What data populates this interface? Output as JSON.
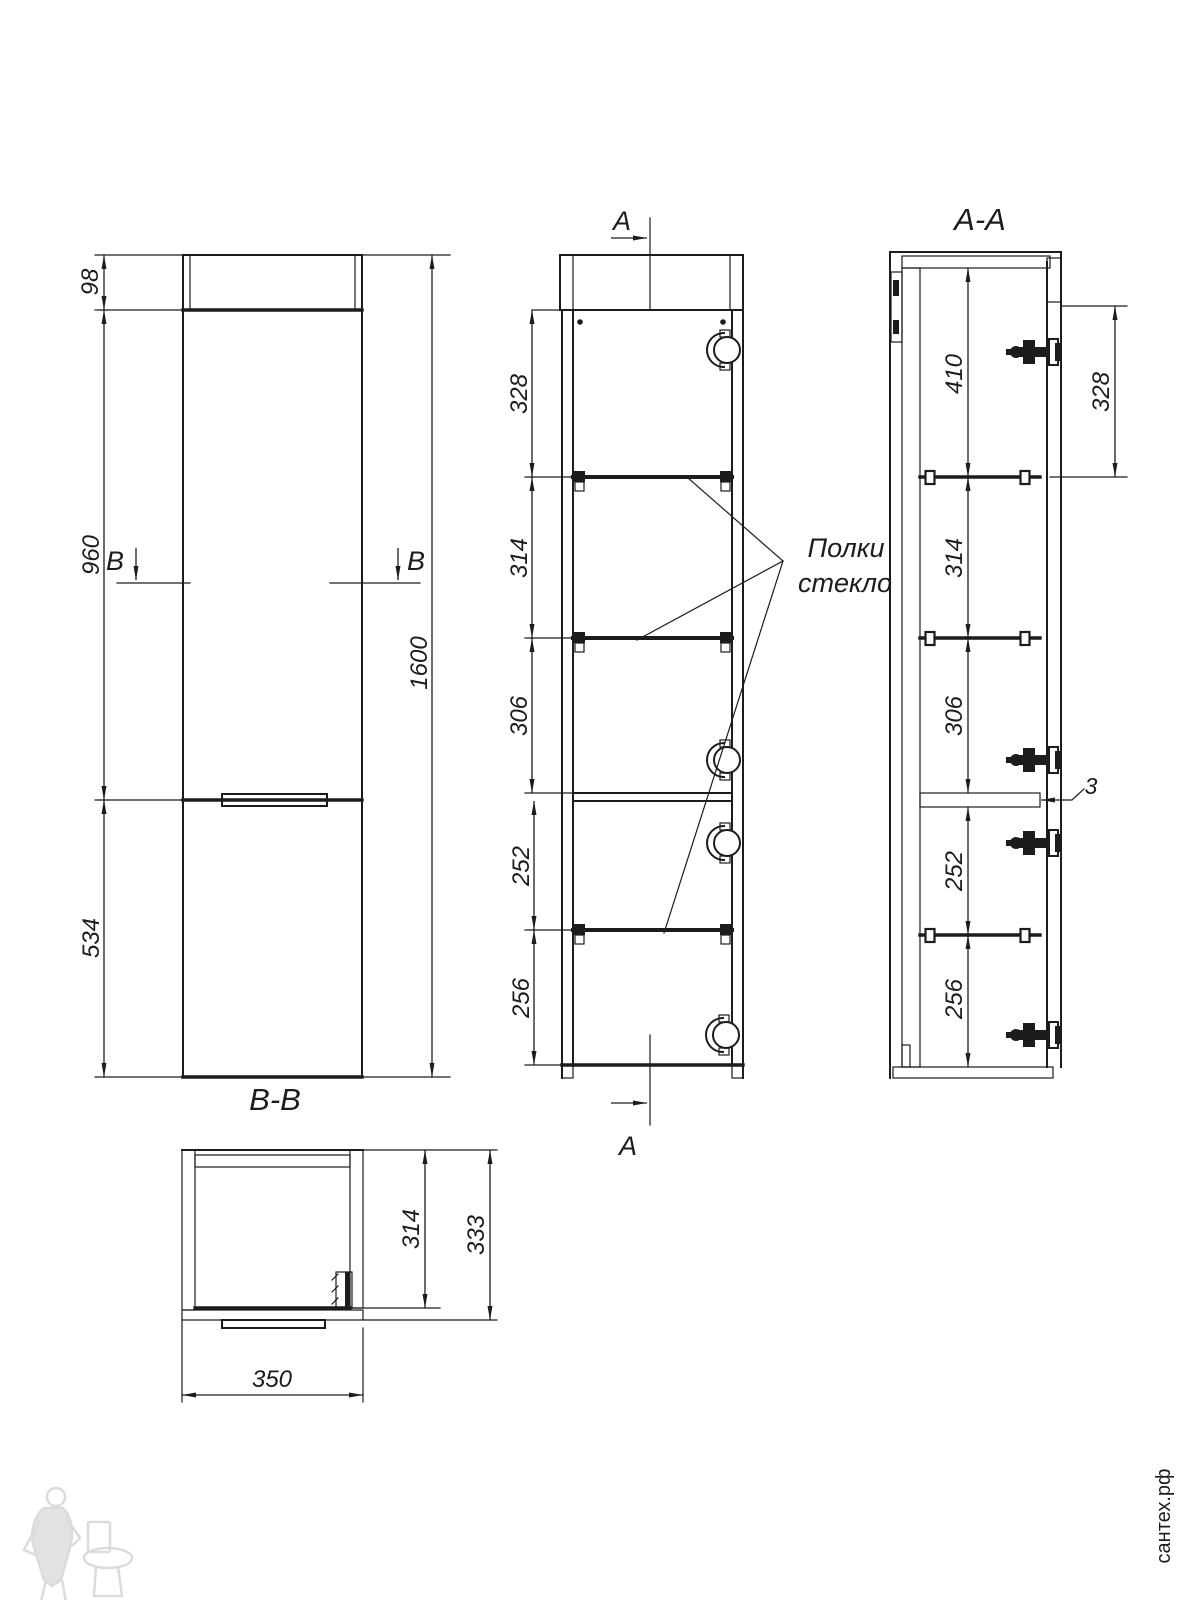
{
  "colors": {
    "line": "#1c1c1c",
    "background": "#ffffff",
    "watermark_gray": "#c2c2c2"
  },
  "front_view": {
    "cut_label": "B",
    "dim_crown_height": "98",
    "dim_upper_section": "960",
    "dim_lower_section": "534",
    "dim_total_height": "1600"
  },
  "side_view": {
    "cut_label": "A",
    "dim_shelf_1": "328",
    "dim_shelf_2": "314",
    "dim_shelf_3": "306",
    "dim_shelf_4": "252",
    "dim_shelf_5": "256",
    "callout_line_1": "Полки",
    "callout_line_2": "стекло"
  },
  "section_aa": {
    "title": "A-A",
    "dim_top_inner": "410",
    "dim_door_top": "328",
    "dim_shelf_2": "314",
    "dim_shelf_3": "306",
    "dim_gap": "3",
    "dim_shelf_4": "252",
    "dim_shelf_5": "256"
  },
  "section_bb": {
    "title": "B-B",
    "dim_inner_depth": "314",
    "dim_outer_depth": "333",
    "dim_width": "350"
  },
  "watermark": {
    "site_text": "сантех.рф"
  }
}
